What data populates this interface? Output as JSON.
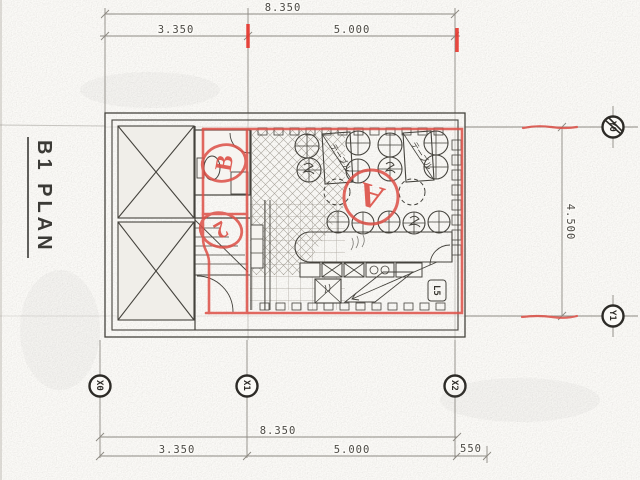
{
  "title": "B1 PLAN",
  "dims": {
    "top_total": "8.350",
    "top_seg1": "3.350",
    "top_seg2": "5.000",
    "right_total": "4.500",
    "bottom_total": "8.350",
    "bottom_seg1": "3.350",
    "bottom_seg2": "5.000",
    "bottom_seg3": "550"
  },
  "grid": {
    "x0": "X0",
    "x1": "X1",
    "x2": "X2",
    "y0": "Y0",
    "y1": "Y1"
  },
  "labels": {
    "table1": "テーブル",
    "table2": "テーブル",
    "stair_level": "L5"
  },
  "redmarks": {
    "a": "A",
    "b": "B",
    "two": "2"
  },
  "colors": {
    "red_marker": "#dd4f46",
    "red_tick": "#e8352c",
    "pencil": "#45433d",
    "paper": "#fbfaf7"
  }
}
